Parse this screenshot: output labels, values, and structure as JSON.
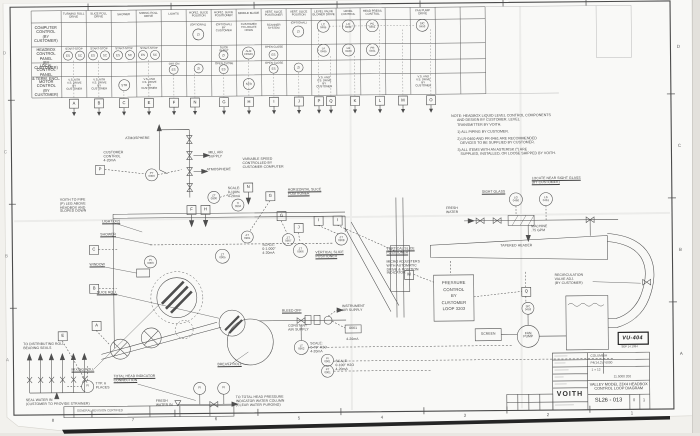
{
  "matrix": {
    "row_labels": {
      "r1": "COMPUTER\nCONTROL\n(BY CUSTOMER)",
      "r2": "HEADBOX\nCONTROL PANEL\n(BY CUSTOMER)",
      "r3": "LOCAL\nCONTROL PANEL\n& TERM. ENCL.",
      "r4": "MOTOR\nCONTROL\n(BY CUSTOMER)"
    },
    "headers": {
      "c1": "TURNING ROLL\nDRIVE",
      "c2": "SLICE ROLL\nDRIVE",
      "c3": "SHOWER",
      "c4": "MIXING ROLL\nDRIVE",
      "c5": "LIGHTS",
      "c6": "HORIZ. SLICE\nPOSITION",
      "c7": "HORIZ. SLICE\nPOSITIONER",
      "c8": "MIDDLE BLADE",
      "c9": "VERT. SLICE\nPOSITIONER",
      "c10": "VERT. SLICE\nPOSITION",
      "c11": "LEVEL VALVE\nBLOWER DRIVE",
      "c12": "LEVEL\nCONTROL",
      "c13": "HEAD PRESS.\nCONTROL",
      "c14": "FAN PUMP\nDRIVE"
    },
    "cells": {
      "start_stop": "START-STOP",
      "es": "ES",
      "sc": "SC",
      "zi": "ZI",
      "str": "STR",
      "optional": "(OPTIONAL)",
      "optional_by_customer": "(OPTIONAL)\nBY\nCUSTOMER",
      "customer_to_locate_horn": "CUSTOMER\nTO LOCATE\nHORN",
      "scanner_system": "SCANNER\nSYSTEM",
      "off_on": "OFF  ON",
      "slice_in_out": "SLICE\nIN  OUT",
      "open_close": "OPEN CLOSE",
      "alm_horn": "ALM\nHORN",
      "vs_drive": "V.S. MTR\nV.S. DRIVE\nBY\nCUSTOMER",
      "vs_drive2": "V.S. AND\nV.S. DRIVE\nBY\nCUSTOMER",
      "lc0465": "LC\n0465",
      "la0465": "LA\n0465",
      "lc0460": "LC\n0460",
      "lr0460": "LR\n0460",
      "pc0461": "PC\n0461",
      "pr0461": "PR\n0461",
      "sic0453": "SIC\n0453"
    },
    "letters": {
      "a": "A",
      "b": "B",
      "c": "C",
      "e": "E",
      "f": "F",
      "n": "N",
      "g": "G",
      "h": "H",
      "i": "I",
      "j": "J",
      "p": "P",
      "q": "Q",
      "k": "K",
      "l": "L",
      "m": "M",
      "o": "O"
    }
  },
  "zones": {
    "n8": "8",
    "n7": "7",
    "n6": "6",
    "n5": "5",
    "n4": "4",
    "n3": "3",
    "n2": "2",
    "n1": "1",
    "d": "D",
    "c": "C",
    "b": "B",
    "a": "A"
  },
  "notes": {
    "head": "NOTE: HEADBOX LIQUID LEVEL CONTROL COMPONENTS\n      AND DESIGN BY CUSTOMER. LEVEL\n      TRANSMITTER BY VOITH.",
    "n1": "1) ALL PIPING BY CUSTOMER.",
    "n2": "2) LR-0460 AND PR-0461 ARE RECOMMENDED\n   DEVICES TO BE SUPPLIED BY CUSTOMER.",
    "n3": "3) ALL ITEMS WITH AN ASTERISK (*) ARE\n   SUPPLIED, INSTALLED, OR LOOSE SHIPPED BY VOITH."
  },
  "diagram": {
    "atmosphere": "ATMOSPHERE",
    "customer_control": "CUSTOMER\nCONTROL\n4-20mA",
    "mill_air": "MILL AIR\nSUPPLY",
    "voith_pipe": "VOITH TO PIPE\n(P) LEG ABOVE\nHEADBOX AND\nSLOPED DOWN",
    "light": "LIGHT (X2)",
    "shower": "SHOWER",
    "window": "WINDOW",
    "slice_roll": "SLICE ROLL",
    "variable_speed": "VARIABLE SPEED\nCONTROLLED BY\nCUSTOMER COMPUTER",
    "horizontal_slice": "HORIZONTAL SLICE\nPOSITIONER",
    "vertical_slice": "VERTICAL SLICE\nPOSITIONER",
    "micro_adjusters": "MICRO ADJUSTERS\nWITH AUTOMATIC\nDRIVE & POSITION\nINDICATOR",
    "scale_1000": "SCALE:\n0-1.000\"\n4-20mA",
    "scale_pct": "SCALE:\n0-100%\n4-20mA",
    "bleed_off": "BLEED OFF",
    "instrument_air": "INSTRUMENT\nAIR SUPPLY",
    "constant_air": "CONSTANT\nAIR SUPPLY",
    "ma420": "4-20mA",
    "box0661": "0661",
    "scale_70": "SCALE:\n0-70\" H2O\n4-20mA",
    "scale_100": "SCALE:\n0-100\" H2O\n4-20mA",
    "breast_roll": "BREAST ROLL",
    "mixing_roll": "MIXING ROLL",
    "total_head": "TOTAL HEAD INDICATOR\nCONNECTION",
    "typ6": "TYP. 6\nPLACES",
    "dist_roll": "TO DISTRIBUTING ROLL\nBEARING SEALS",
    "seal_water": "SEAL WATER IN\n(CUSTOMER TO PROVIDE STRAINER)",
    "fresh_water_in": "FRESH\nWATER IN",
    "total_head_purge": "TO TOTAL HEAD PRESSURE\nINDICATOR WATER COLUMN\n(CLEAR WATER PURGING)",
    "fresh_water": "FRESH\nWATER",
    "sight_glass": "SIGHT GLASS",
    "locate_near": "LOCATE NEAR SIGHT GLASS\n(BY CUSTOMER)",
    "machine": "MACHINE\n.75 GPM",
    "tapered_header": "TAPERED HEADER",
    "pressure_control": "PRESSURE\nCONTROL\nBY\nCUSTOMER\nLOOP 3203",
    "recirc": "RECIRCULATION\nVALVE ADJ.\n(BY CUSTOMER)",
    "screen": "SCREEN",
    "fan_pump": "FAN\nPUMP"
  },
  "instruments": {
    "py0900": "PY\n0900",
    "zt0900": "ZT\n0900",
    "ti0904": "TI\n0904",
    "pi0903": "PI\n0903",
    "zt0905": "ZT\n0905",
    "zt0906": "ZT\n0906",
    "zt0901": "ZT\n0901",
    "zt0907": "ZT\n0907",
    "zt0908": "ZT\n0908",
    "lt0902": "LT\n0902",
    "pi0901": "PI\n0901",
    "pt0901": "PT\n0901",
    "fi": "FI",
    "lg0460": "LG\n0460",
    "ls0461": "LS\n0461",
    "sic0453": "SIC\n0453"
  },
  "titleblock": {
    "brand": "VOITH",
    "customer": "COLUMBIA",
    "field1": "P4(14,2) / 6000",
    "scale": "1 = 12",
    "field2": "11.5000 200",
    "title": "VALLEY MODEL 23X4 HEADBOX\nCONTROL LOOP DIAGRAM",
    "dwg_no": "SL26 - 013",
    "rev0": "0",
    "rev1": "1",
    "strip": "GENERAL REVISION CERTIFIED"
  },
  "stamp": {
    "code": "VU-404",
    "date": "SEP 14 1994"
  }
}
